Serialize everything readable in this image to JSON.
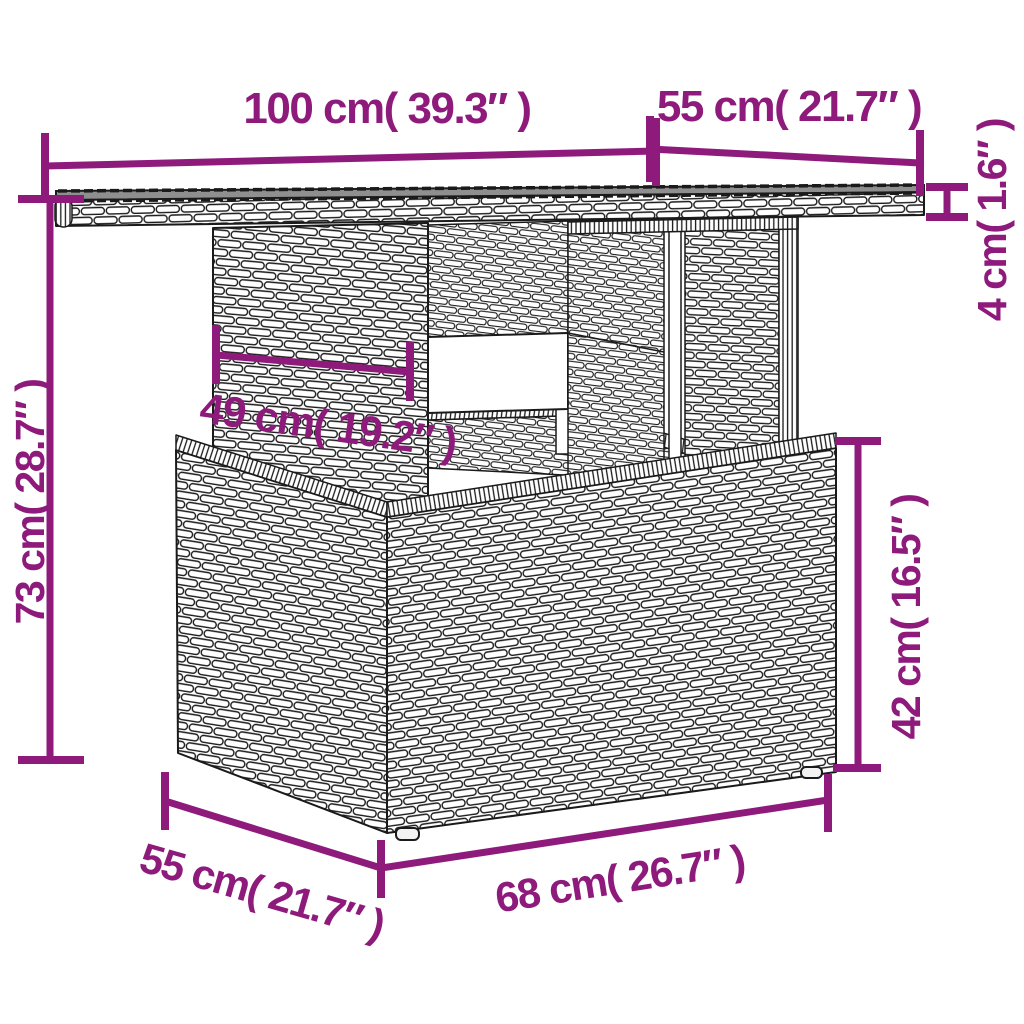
{
  "colors": {
    "accent": "#8E1B7C",
    "outline": "#1A1A1A",
    "glass": "#8F8F8F",
    "background": "#FFFFFF"
  },
  "labels": {
    "tabletop_width": "100 cm( 39.3″ )",
    "tabletop_depth": "55 cm( 21.7″ )",
    "tabletop_thickness": "4 cm( 1.6″ )",
    "overall_height": "73 cm( 28.7″ )",
    "pedestal_width": "49 cm( 19.2″ )",
    "base_height": "42 cm( 16.5″ )",
    "base_depth": "55 cm( 21.7″ )",
    "base_width": "68 cm( 26.7″ )"
  }
}
